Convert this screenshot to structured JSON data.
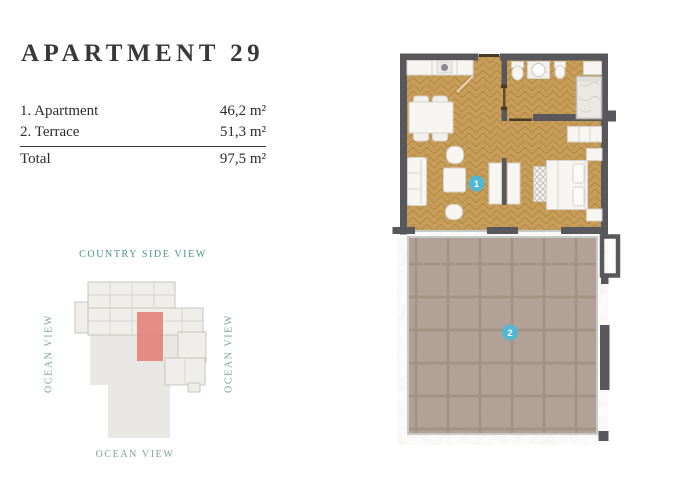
{
  "page": {
    "background": "#ffffff"
  },
  "header": {
    "title": "APARTMENT 29"
  },
  "area_table": {
    "rows": [
      {
        "label": "1. Apartment",
        "value": "46,2 m²"
      },
      {
        "label": "2. Terrace",
        "value": "51,3 m²"
      }
    ],
    "total_label": "Total",
    "total_value": "97,5 m²"
  },
  "site_map": {
    "top_label": "COUNTRY SIDE VIEW",
    "left_label": "OCEAN VIEW",
    "right_label": "OCEAN VIEW",
    "bottom_label": "OCEAN VIEW",
    "highlight_color": "#e57a72",
    "top_label_color": "#4e9381",
    "side_label_color": "#7ba49a"
  },
  "floor_plan": {
    "badges": [
      {
        "number": "1"
      },
      {
        "number": "2"
      }
    ],
    "badge_color": "#52b7d4",
    "wall_color": "#58585c",
    "wood_color": "#c89d57",
    "tile_color": "#b3a196"
  }
}
